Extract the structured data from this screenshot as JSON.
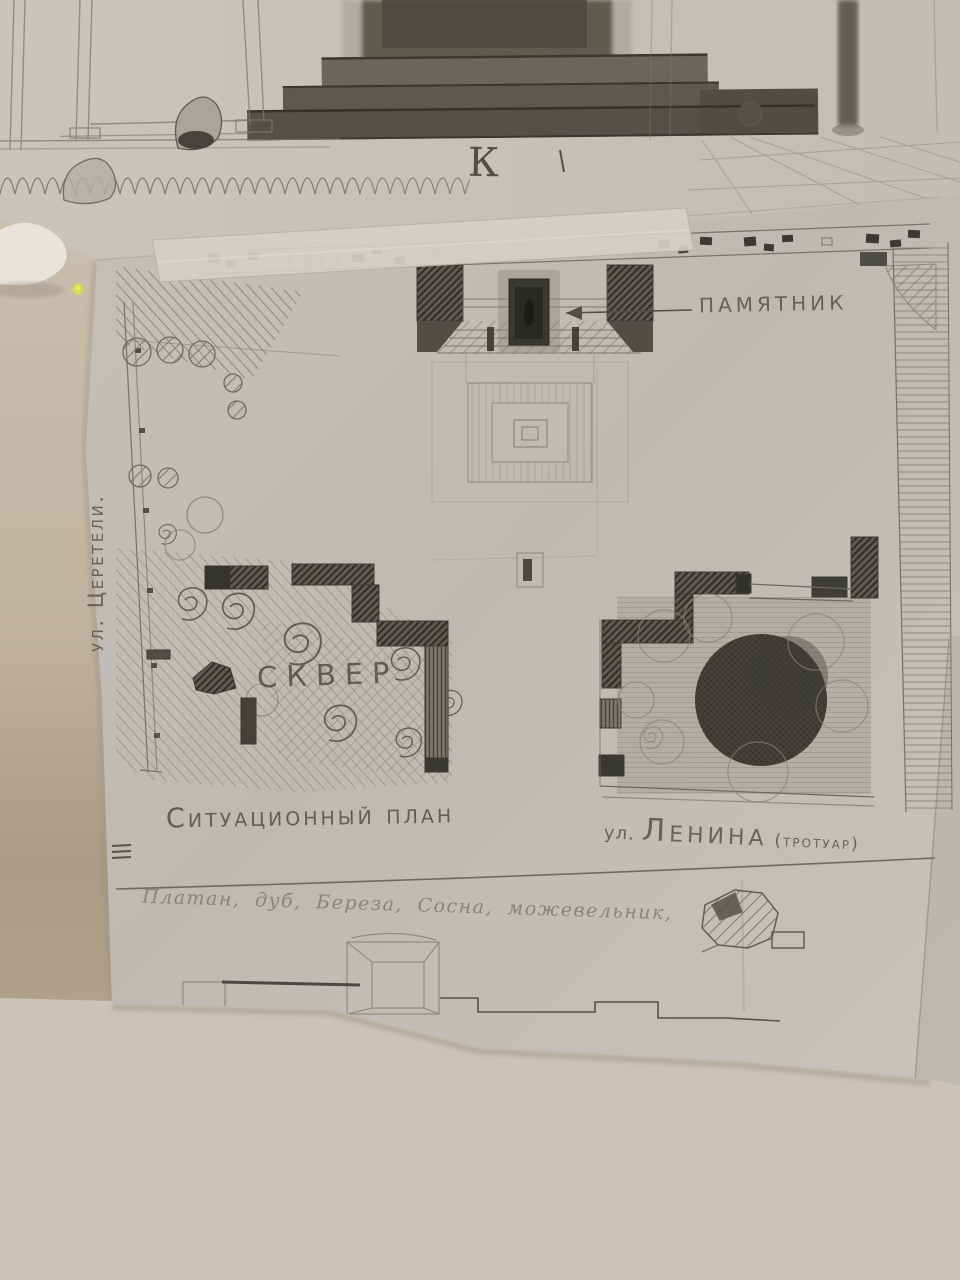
{
  "photo": {
    "letter_k": "К",
    "monument_label": "ПАМЯТНИК",
    "street_tsereteli": "ул. Церетели.",
    "skver_label": "СКВЕР",
    "plan_caption": "Ситуационный план",
    "lenina_prefix": "ул.",
    "lenina_name": "Ленина",
    "lenina_suffix": "(тротуар)",
    "species_note": "Платан, дуб, Береза, Сосна, можевельник,"
  },
  "colors": {
    "wall": "#cdc7ba",
    "wall_shadow_tan": "#a6967f",
    "paper_upper_sheet": "#c6c2ba",
    "paper_plan_sheet": "#bfbcb4",
    "tape": "#d4d0c8",
    "pencil_line": "#6b675f",
    "pencil_dark": "#3c3a34",
    "graphite_fill": "#45423c",
    "highlight_dot": "#d8df44"
  }
}
